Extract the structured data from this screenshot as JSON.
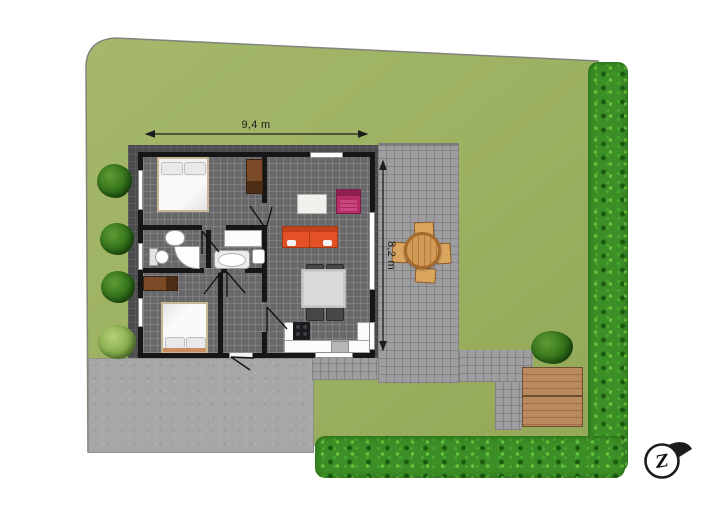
{
  "plan": {
    "type": "residential site / floor plan (top view)",
    "dimensions": {
      "width_label": "9,4 m",
      "depth_label": "8,2 m"
    },
    "compass": {
      "label": "Z"
    },
    "colors": {
      "grass": "#9fb364",
      "hedge": "#3c8f26",
      "patio_tile": "#9e9ea1",
      "concrete": "#a7a7a5",
      "house_floor": "#68686a",
      "wall": "#161616",
      "roof_band": "#4b4b4e",
      "deck_wood": "#b98a5f",
      "sofa_orange": "#e55127",
      "armchair_magenta": "#b62d67",
      "cabinet_brown": "#7b4b28",
      "garden_wood": "#d9a55f"
    },
    "rooms_visible": [
      "bedroom-1",
      "bathroom",
      "second-bathroom",
      "bedroom-2",
      "hall",
      "living-room",
      "kitchen"
    ],
    "outdoor_features": [
      "lawn",
      "left-shrub-row",
      "right-hedge",
      "bottom-hedge",
      "patio-terrace",
      "garden-table-set",
      "wooden-deck",
      "concrete-driveway"
    ]
  }
}
